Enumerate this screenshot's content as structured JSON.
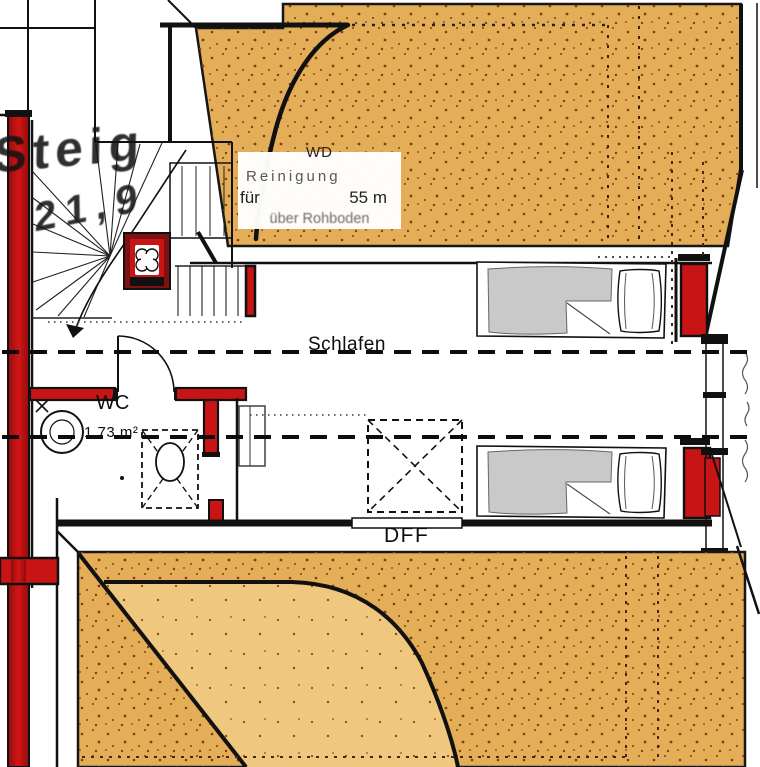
{
  "plan": {
    "rooms": {
      "sleep_label": "Schlafen",
      "wc_label": "WC",
      "wc_area": "1,73 m²",
      "roof_window_label": "DFF"
    },
    "note_box": {
      "line1": "WD",
      "line2": "Reinigung",
      "line3_left": "für",
      "line3_right": "55 m",
      "line4": "über Rohboden"
    },
    "stair_annotation": {
      "line1": "Steig",
      "line2": "21,9"
    },
    "colors": {
      "wall_red": "#c81414",
      "wall_red_dark": "#8f0d0d",
      "roof_fill": "#e4ae59",
      "roof_fill_light": "#f0c77e",
      "stipple_dot": "#7c3f0e",
      "ink": "#111111",
      "bed_gray": "#c9c9c9",
      "dashed_dark": "#4a2410"
    }
  }
}
